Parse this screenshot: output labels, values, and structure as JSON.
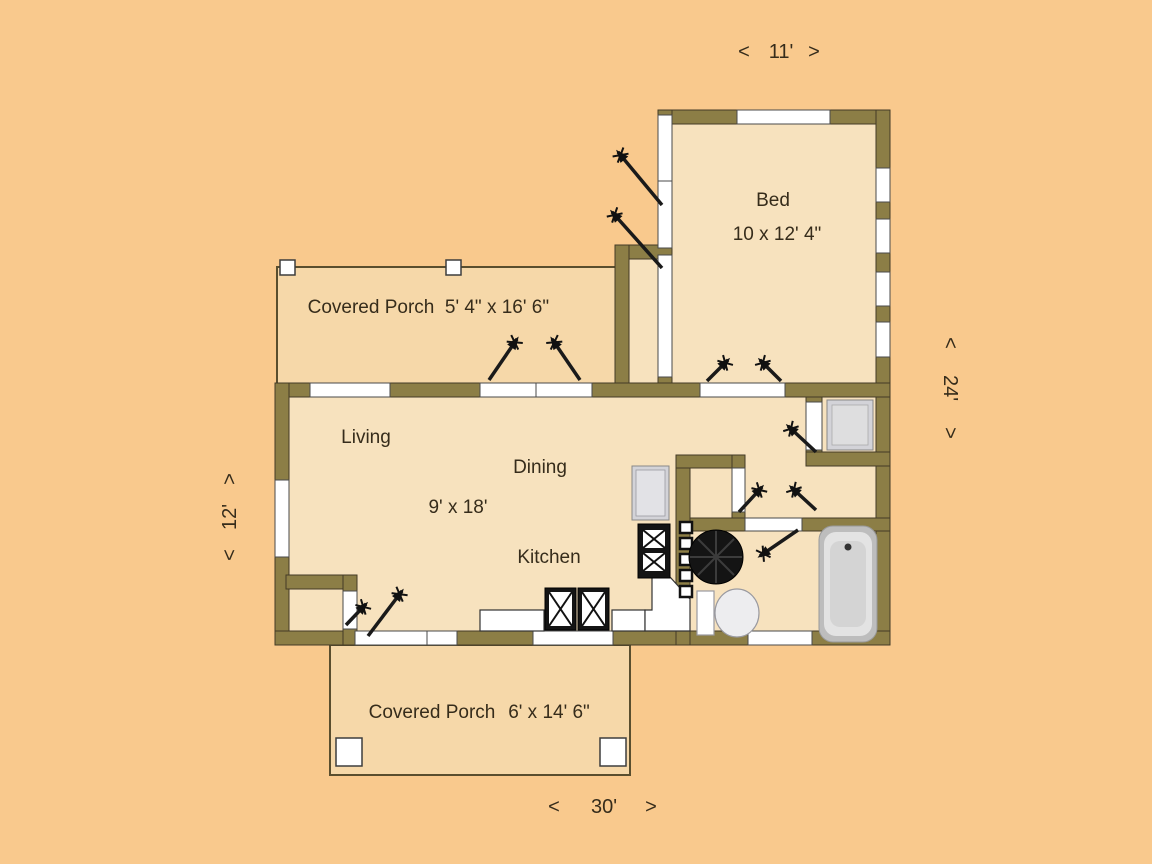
{
  "colors": {
    "background": "#f9c98d",
    "room_fill": "#f7e2be",
    "porch_fill": "#f6d8a9",
    "wall": "#8c7e46",
    "text": "#362c1b",
    "opening_white": "#ffffff"
  },
  "rooms": {
    "bed": {
      "label": "Bed",
      "size": "10 x 12' 4\""
    },
    "porch_top": {
      "label": "Covered Porch",
      "size": "5' 4\" x 16' 6\""
    },
    "living": {
      "label": "Living"
    },
    "dining": {
      "label": "Dining"
    },
    "main_size": "9' x 18'",
    "kitchen": {
      "label": "Kitchen"
    },
    "porch_bottom": {
      "label": "Covered Porch",
      "size": "6' x 14' 6\""
    }
  },
  "dims": {
    "top": {
      "open": "<",
      "value": "11'",
      "close": ">"
    },
    "right": {
      "open": "<",
      "value": "24'",
      "close": ">"
    },
    "left": {
      "open": "<",
      "value": "12'",
      "close": ">"
    },
    "bottom": {
      "open": "<",
      "value": "30'",
      "close": ">"
    }
  },
  "fixtures": [
    "refrigerator",
    "range",
    "kitchen-sink",
    "ladder",
    "wood-stove",
    "toilet",
    "bathtub",
    "washer",
    "porch-post",
    "window",
    "door-swing-arrow"
  ]
}
